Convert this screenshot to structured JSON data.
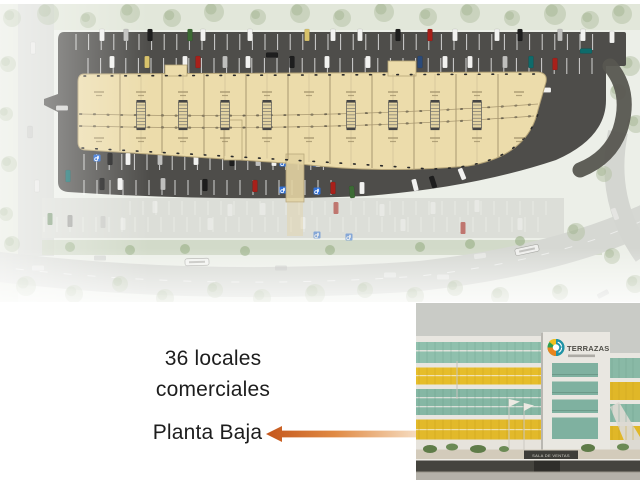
{
  "caption": {
    "line1": "36 locales",
    "line2": "comerciales",
    "subtitle": "Planta Baja"
  },
  "photo": {
    "logo_text": "TERRAZAS",
    "sales_sign_text": "SALA DE VENTAS"
  },
  "colors": {
    "arrow_orange": "#cd6226",
    "plan_building_fill": "#ecdcab",
    "plan_asphalt": "#4e4d4a",
    "photo_yellow": "#e5bd2b",
    "photo_teal": "#8fc0ad",
    "photo_sky": "#c9cbc6",
    "handicap_blue": "#2f6fd6"
  }
}
